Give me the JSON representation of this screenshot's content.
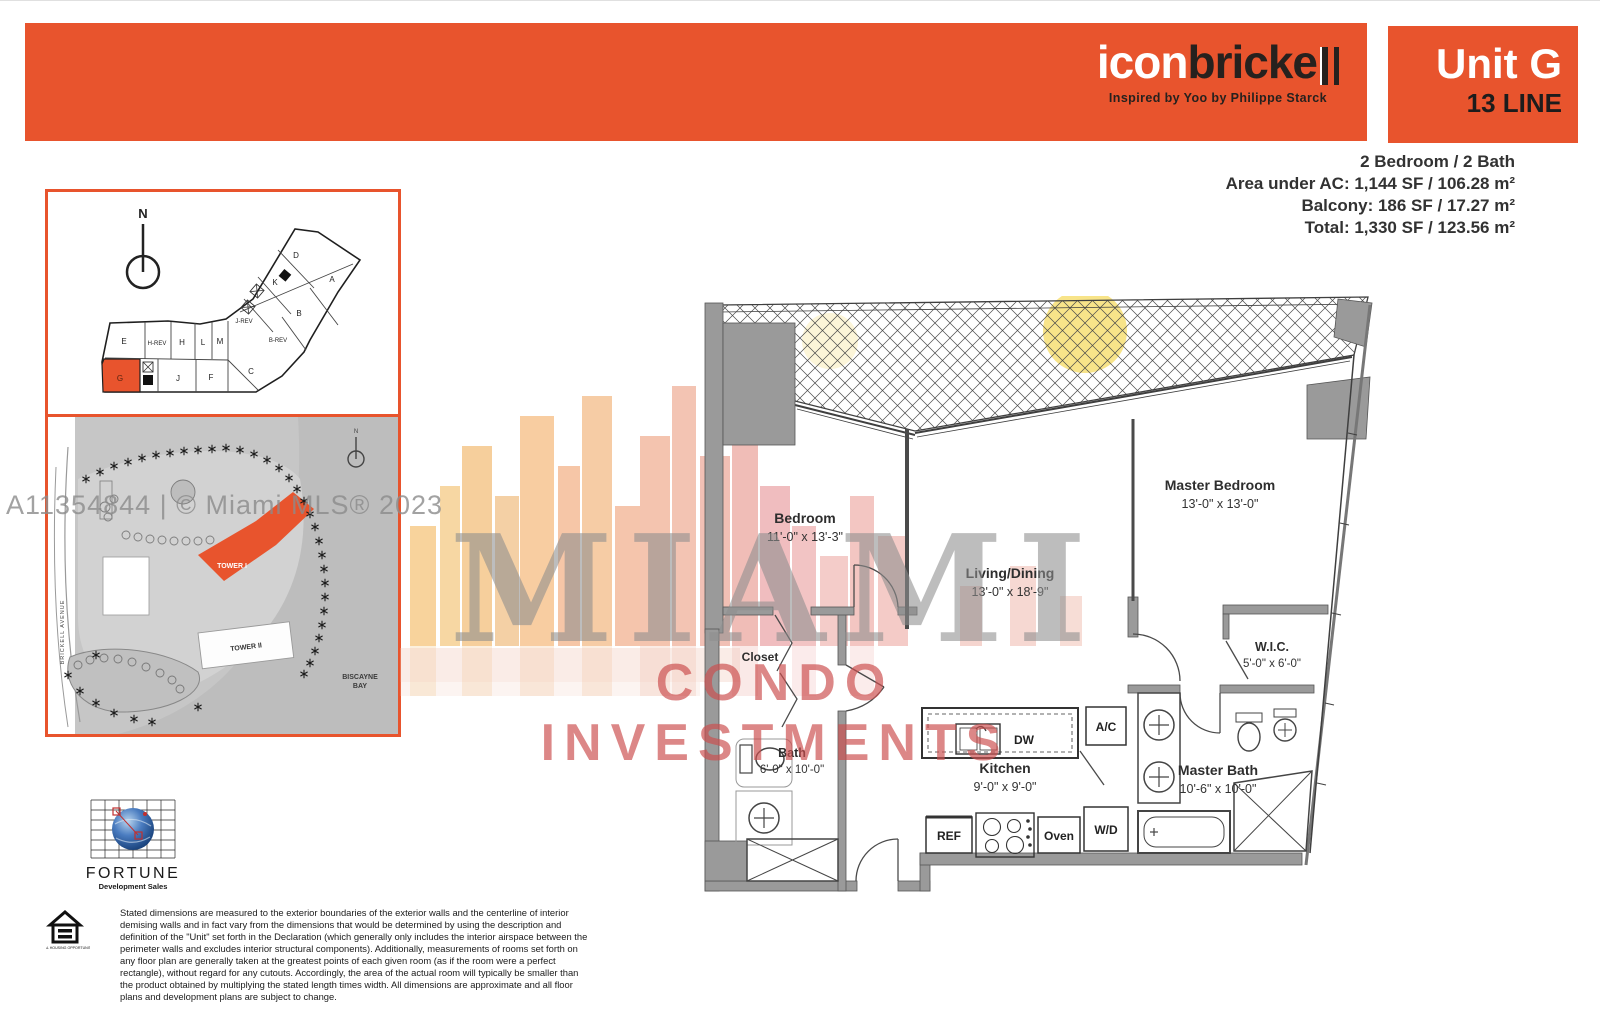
{
  "header": {
    "logo": {
      "white": "icon",
      "dark": "bricke",
      "tagline": "Inspired by Yoo by Philippe Starck"
    },
    "unit": {
      "name": "Unit G",
      "line": "13 LINE"
    }
  },
  "stats": [
    "2 Bedroom / 2 Bath",
    "Area under AC: 1,144 SF / 106.28 m²",
    "Balcony: 186 SF / 17.27 m²",
    "Total: 1,330 SF / 123.56 m²"
  ],
  "keyplan": {
    "north": "N",
    "highlighted": "G",
    "units": [
      "D",
      "K",
      "A",
      "B",
      "J-REV",
      "B-REV",
      "E",
      "H-REV",
      "H",
      "L",
      "M",
      "C",
      "G",
      "J",
      "F"
    ]
  },
  "siteplan": {
    "tower1": "TOWER I",
    "tower2": "TOWER II",
    "bay1": "BISCAYNE",
    "bay2": "BAY",
    "street": "BRICKELL AVENUE",
    "north": "N"
  },
  "watermarks": {
    "mls": "A11354844 | © Miami MLS® 2023",
    "title": "MIAMI",
    "subtitle": "CONDO INVESTMENTS"
  },
  "floorplan": {
    "rooms": [
      {
        "name": "Bedroom",
        "dims": "11'-0\" x 13'-3\""
      },
      {
        "name": "Living/Dining",
        "dims": "13'-0\" x 18'-9\""
      },
      {
        "name": "Master Bedroom",
        "dims": "13'-0\" x 13'-0\""
      },
      {
        "name": "W.I.C.",
        "dims": "5'-0\" x 6'-0\""
      },
      {
        "name": "Master Bath",
        "dims": "10'-6\" x 10'-0\""
      },
      {
        "name": "Bath",
        "dims": "6'-0\" x 10'-0\""
      },
      {
        "name": "Kitchen",
        "dims": "9'-0\" x 9'-0\""
      },
      {
        "name": "Closet",
        "dims": ""
      }
    ],
    "fixtures": {
      "ref": "REF",
      "dw": "DW",
      "oven": "Oven",
      "ac": "A/C",
      "wd": "W/D"
    }
  },
  "footer": {
    "fortune": {
      "name": "FORTUNE",
      "sub": "Development Sales"
    },
    "equal_housing": "EQUAL HOUSING OPPORTUNITY",
    "disclaimer": "Stated dimensions are measured to the exterior boundaries of the exterior walls and the centerline of interior demising walls and in fact vary from the dimensions that would be determined by using the description and definition of the \"Unit\" set forth in the Declaration (which generally only includes the interior airspace between the perimeter walls and excludes interior structural components). Additionally, measurements of rooms set forth on any floor plan are generally taken at the greatest points of each given room (as if the room were a perfect rectangle), without regard for any cutouts. Accordingly, the area of the actual room will typically be smaller than the product obtained by multiplying the stated length times width. All dimensions are approximate and all floor plans and development plans are subject to change."
  },
  "colors": {
    "accent_orange": "#E8542D",
    "watermark_red": "#CC4F4F",
    "watermark_gray": "#8E8E8E"
  }
}
